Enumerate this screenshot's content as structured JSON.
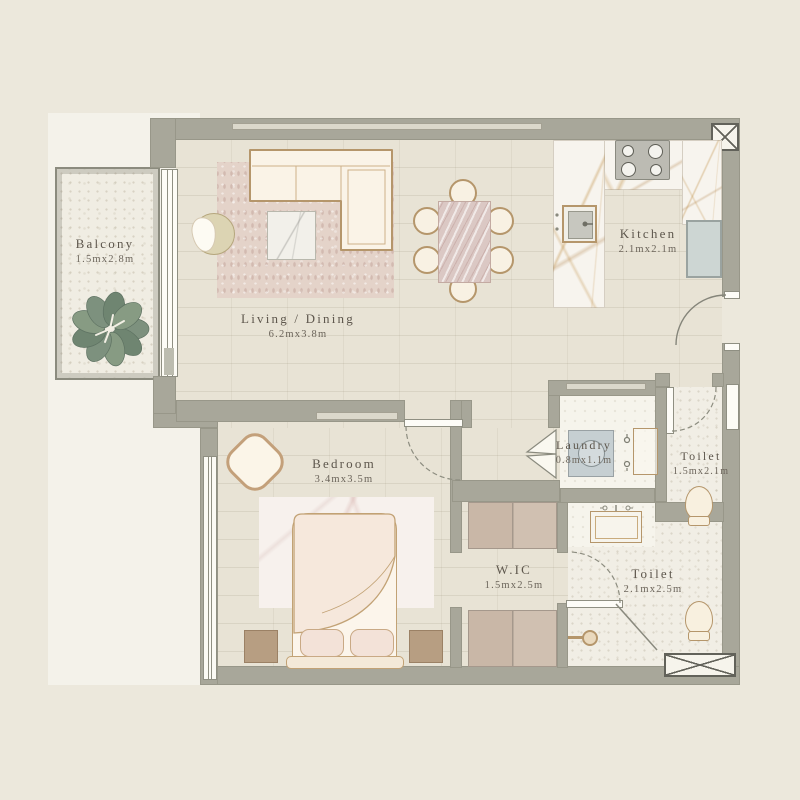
{
  "plan_title": "One-bedroom apartment floor plan",
  "rooms": {
    "balcony": {
      "name": "Balcony",
      "dims": "1.5mx2.8m"
    },
    "living": {
      "name": "Living / Dining",
      "dims": "6.2mx3.8m"
    },
    "kitchen": {
      "name": "Kitchen",
      "dims": "2.1mx2.1m"
    },
    "bedroom": {
      "name": "Bedroom",
      "dims": "3.4mx3.5m"
    },
    "laundry": {
      "name": "Laundry",
      "dims": "0.8mx1.1m"
    },
    "toilet_top": {
      "name": "Toilet",
      "dims": "1.5mx2.1m"
    },
    "wic": {
      "name": "W.IC",
      "dims": "1.5mx2.5m"
    },
    "toilet_bottom": {
      "name": "Toilet",
      "dims": "2.1mx2.5m"
    }
  },
  "colors": {
    "page": "#ece8dc",
    "backdrop": "#f4f2ea",
    "wall": "#a8a79a",
    "floor": "#e8e3d5",
    "tan": "#b5966b",
    "cream": "#faf3e6",
    "appliance_blue": "#c6cfd2",
    "plant_green": "#7d917e",
    "text": "#5d564c"
  }
}
